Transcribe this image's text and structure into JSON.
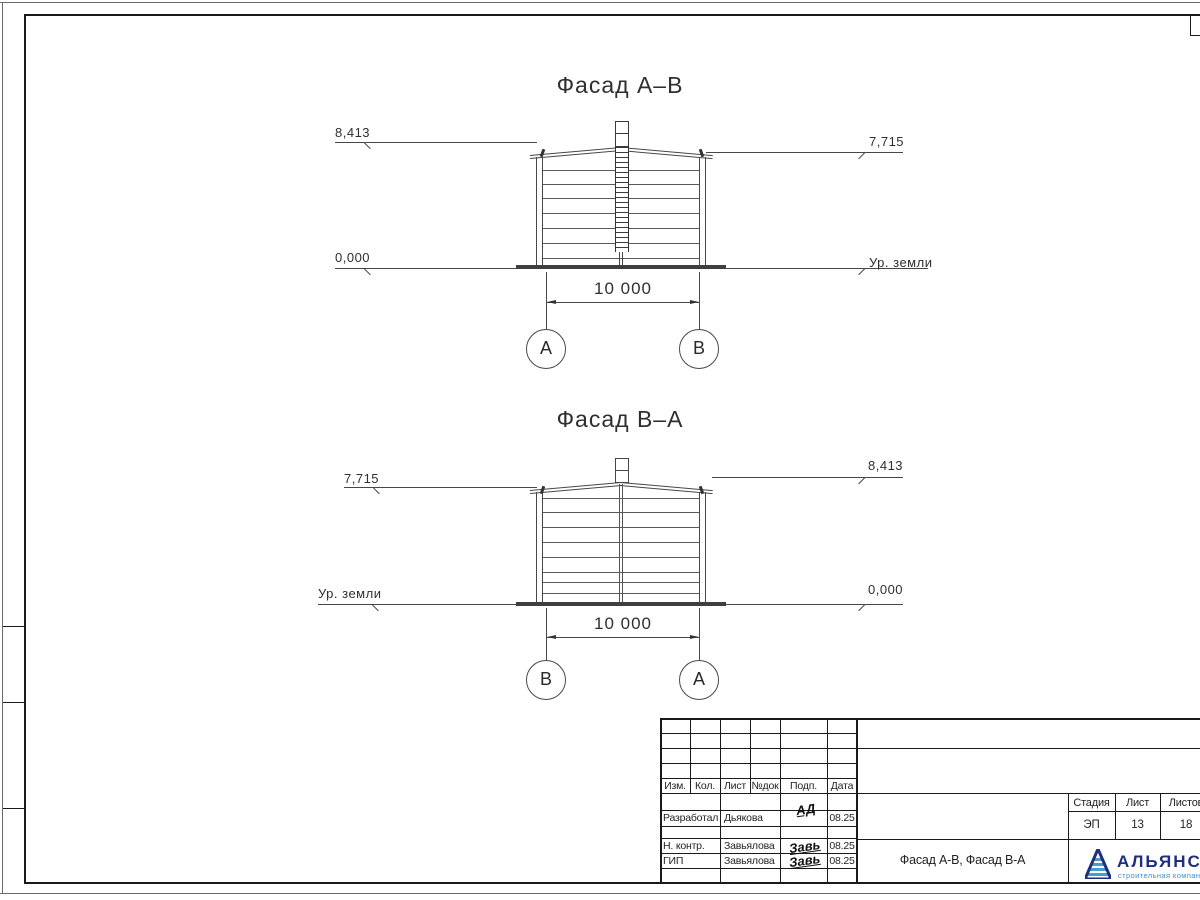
{
  "facades": [
    {
      "title": "Фасад А–В",
      "marks": {
        "left_top": "8,413",
        "left_bottom": "0,000",
        "right_top": "7,715",
        "right_bottom": "Ур. земли"
      },
      "dimension": "10 000",
      "axis_left": "А",
      "axis_right": "В"
    },
    {
      "title": "Фасад В–А",
      "marks": {
        "left_top": "7,715",
        "left_bottom": "Ур. земли",
        "right_top": "8,413",
        "right_bottom": "0,000"
      },
      "dimension": "10 000",
      "axis_left": "В",
      "axis_right": "А"
    }
  ],
  "titleblock": {
    "header": {
      "izm": "Изм.",
      "kol": "Кол.",
      "list": "Лист",
      "ndok": "№док",
      "podp": "Подп.",
      "data": "Дата"
    },
    "rows": [
      {
        "role": "Разработал",
        "name": "Дьякова",
        "sign": "АД",
        "date": "08.25"
      },
      {
        "role": "Н. контр.",
        "name": "Завьялова",
        "sign": "Завь",
        "date": "08.25"
      },
      {
        "role": "ГИП",
        "name": "Завьялова",
        "sign": "Завь",
        "date": "08.25"
      }
    ],
    "stage_table": {
      "headers": [
        "Стадия",
        "Лист",
        "Листов"
      ],
      "values": [
        "ЭП",
        "13",
        "18"
      ]
    },
    "doc_title": "Фасад А-В, Фасад В-А",
    "logo": {
      "name": "АЛЬЯНС",
      "tagline": "строительная компания",
      "color_primary": "#1d2f7e",
      "color_secondary": "#4a9bd4"
    }
  }
}
